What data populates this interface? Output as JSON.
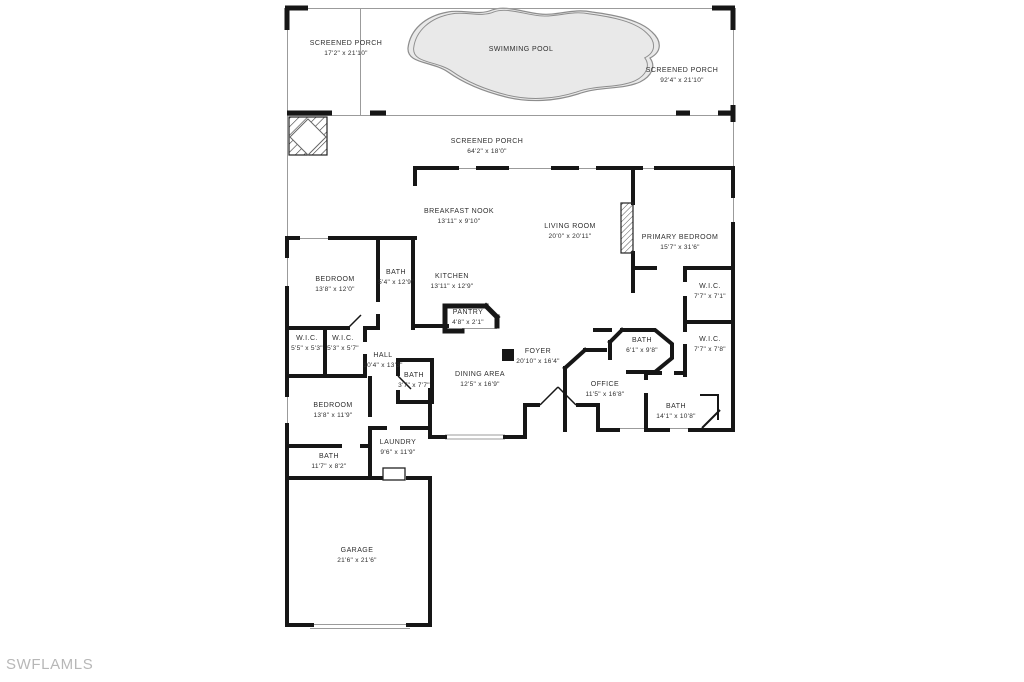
{
  "watermark": "SWFLAMLS",
  "colors": {
    "wall": "#161616",
    "screen_line": "#9b9b9b",
    "pool_fill": "#e9e9e9",
    "pool_outline": "#8d8d8d",
    "label_text": "#2e2e2e",
    "watermark_text": "#b7b7b7",
    "background": "#ffffff"
  },
  "plan": {
    "rooms": [
      {
        "name": "SCREENED PORCH",
        "dims": "17'2\" x 21'10\""
      },
      {
        "name": "SWIMMING POOL",
        "dims": ""
      },
      {
        "name": "SCREENED PORCH",
        "dims": "92'4\" x 21'10\""
      },
      {
        "name": "SCREENED PORCH",
        "dims": "64'2\" x 18'0\""
      },
      {
        "name": "BREAKFAST NOOK",
        "dims": "13'11\" x 9'10\""
      },
      {
        "name": "LIVING ROOM",
        "dims": "20'0\" x 20'11\""
      },
      {
        "name": "PRIMARY BEDROOM",
        "dims": "15'7\" x 31'6\""
      },
      {
        "name": "BEDROOM",
        "dims": "13'8\" x 12'0\""
      },
      {
        "name": "BATH",
        "dims": "5'4\" x 12'9\""
      },
      {
        "name": "KITCHEN",
        "dims": "13'11\" x 12'9\""
      },
      {
        "name": "PANTRY",
        "dims": "4'8\" x 2'1\""
      },
      {
        "name": "W.I.C.",
        "dims": "7'7\" x 7'1\""
      },
      {
        "name": "W.I.C.",
        "dims": "7'7\" x 7'8\""
      },
      {
        "name": "W.I.C.",
        "dims": "5'5\" x 5'3\""
      },
      {
        "name": "W.I.C.",
        "dims": "5'3\" x 5'7\""
      },
      {
        "name": "HALL",
        "dims": "10'4\" x 13'3\""
      },
      {
        "name": "BATH",
        "dims": "3'7\" x 7'7\""
      },
      {
        "name": "FOYER",
        "dims": "20'10\" x 16'4\""
      },
      {
        "name": "DINING AREA",
        "dims": "12'5\" x 16'9\""
      },
      {
        "name": "BATH",
        "dims": "6'1\" x 9'8\""
      },
      {
        "name": "OFFICE",
        "dims": "11'5\" x 16'8\""
      },
      {
        "name": "BATH",
        "dims": "14'1\" x 10'8\""
      },
      {
        "name": "BEDROOM",
        "dims": "13'8\" x 11'9\""
      },
      {
        "name": "LAUNDRY",
        "dims": "9'6\" x 11'9\""
      },
      {
        "name": "BATH",
        "dims": "11'7\" x 8'2\""
      },
      {
        "name": "GARAGE",
        "dims": "21'6\" x 21'6\""
      }
    ]
  }
}
